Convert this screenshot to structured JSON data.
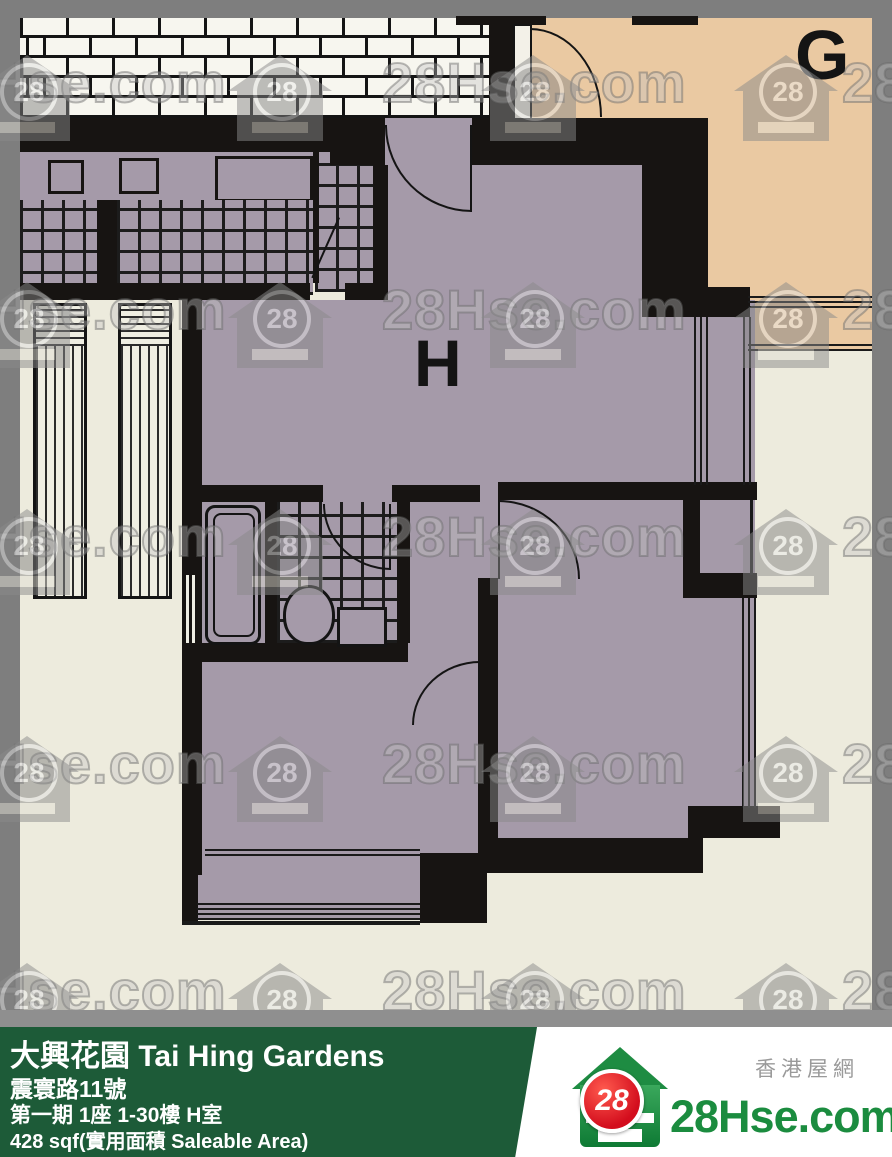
{
  "plan": {
    "unit_h_label": "H",
    "unit_g_label": "G"
  },
  "watermark": {
    "text": "28Hse.com",
    "badge": "28"
  },
  "info_bar": {
    "title": "大興花園 Tai Hing Gardens",
    "address": "震寰路11號",
    "phase_block_floor": "第一期 1座 1-30樓 H室",
    "area": "428 sqf(實用面積 Saleable Area)"
  },
  "logo": {
    "site_name": "28Hse.com",
    "site_name_cn": "香港屋網",
    "badge": "28"
  },
  "colors": {
    "bg_cream": "#edebdd",
    "unit_h_fill": "#a59aa9",
    "unit_g_fill": "#eac9a2",
    "wall_black": "#171412",
    "border_gray": "#7e7e7e",
    "strip_gray": "#8f8f8f",
    "bar_green": "#1d5b38",
    "logo_green": "#1b8c3f",
    "badge_red": "#d30d1d",
    "watermark_gray": "#8a8a8a"
  }
}
